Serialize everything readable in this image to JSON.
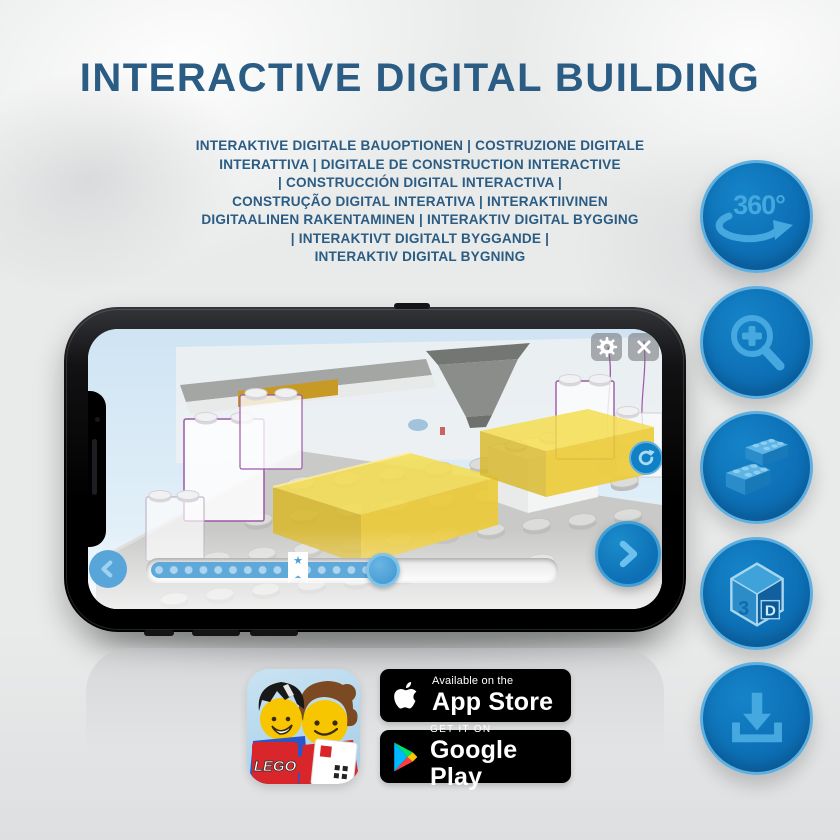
{
  "title": "INTERACTIVE DIGITAL BUILDING",
  "subtitle_lines": [
    "INTERAKTIVE DIGITALE BAUOPTIONEN | COSTRUZIONE DIGITALE",
    "INTERATTIVA | DIGITALE DE CONSTRUCTION INTERACTIVE",
    "| CONSTRUCCIÓN DIGITAL INTERACTIVA |",
    "CONSTRUÇÃO DIGITAL INTERATIVA | INTERAKTIIVINEN",
    "DIGITAALINEN RAKENTAMINEN | INTERAKTIV DIGITAL BYGGING",
    "| INTERAKTIVT DIGITALT BYGGANDE |",
    "INTERAKTIV DIGITAL BYGNING"
  ],
  "features": {
    "rotate_label": "360°",
    "cube_digit": "3",
    "cube_letter": "D",
    "buttons": [
      {
        "id": "rotate-360",
        "icon": "360-rotate-arrow-icon"
      },
      {
        "id": "zoom-in",
        "icon": "magnifier-plus-icon"
      },
      {
        "id": "digital-bricks",
        "icon": "lego-bricks-icon"
      },
      {
        "id": "3d-view",
        "icon": "3d-cube-icon"
      },
      {
        "id": "download",
        "icon": "download-tray-icon"
      }
    ]
  },
  "phone_app": {
    "bookmark_star": "★",
    "progress_percent": 57,
    "icons": [
      "settings-gear",
      "close",
      "rotate-refresh",
      "chevron-left",
      "chevron-right"
    ]
  },
  "badges": {
    "lego_app_label": "LEGO",
    "app_store": {
      "tagline": "Available on the",
      "name": "App Store"
    },
    "google_play": {
      "tagline": "GET IT ON",
      "name": "Google Play"
    }
  },
  "colors": {
    "headline_blue": "#2b5c83",
    "button_blue": "#0d70b6",
    "icon_blue": "#45a8de",
    "brick_yellow": "#f2d74e",
    "screen_sky": "#d9eaf6"
  }
}
